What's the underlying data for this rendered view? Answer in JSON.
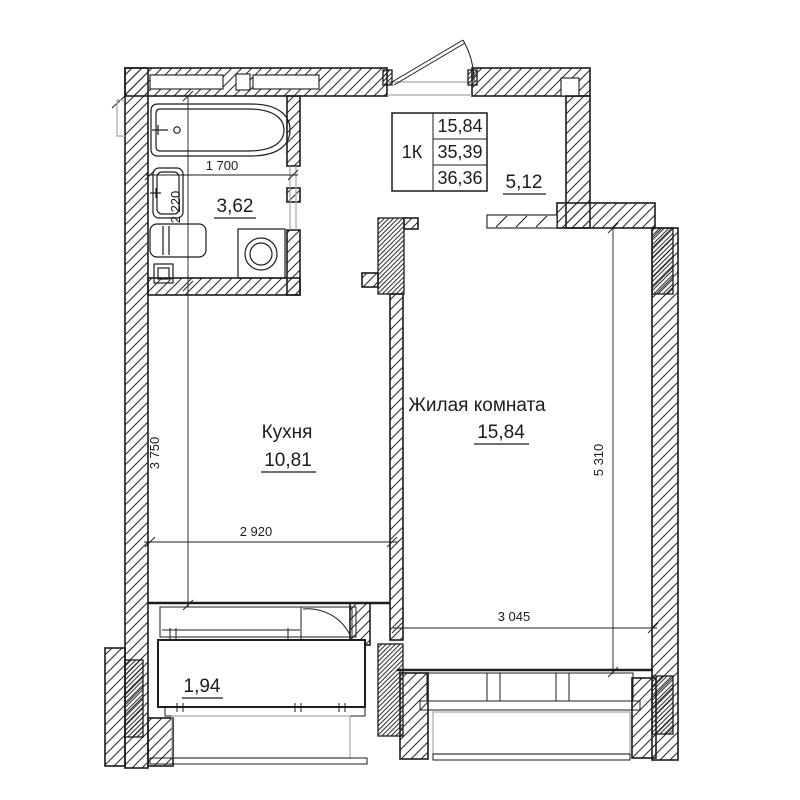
{
  "plan": {
    "summary_table": {
      "type_label": "1К",
      "living_area": "15,84",
      "apartment_area": "35,39",
      "total_area": "36,36"
    },
    "rooms": {
      "kitchen": {
        "name": "Кухня",
        "area": "10,81"
      },
      "living_room": {
        "name": "Жилая комната",
        "area": "15,84"
      },
      "bathroom": {
        "area": "3,62"
      },
      "hallway": {
        "area": "5,12"
      },
      "balcony": {
        "area": "1,94"
      }
    },
    "dimensions": {
      "bathtub_width": "1 700",
      "bathroom_depth": "2 220",
      "kitchen_depth": "3 750",
      "kitchen_width": "2 920",
      "living_depth": "5 310",
      "living_width": "3 045"
    },
    "colors": {
      "line": "#1c1c1c",
      "background": "#ffffff",
      "opening_line": "#a6a6a6"
    }
  }
}
